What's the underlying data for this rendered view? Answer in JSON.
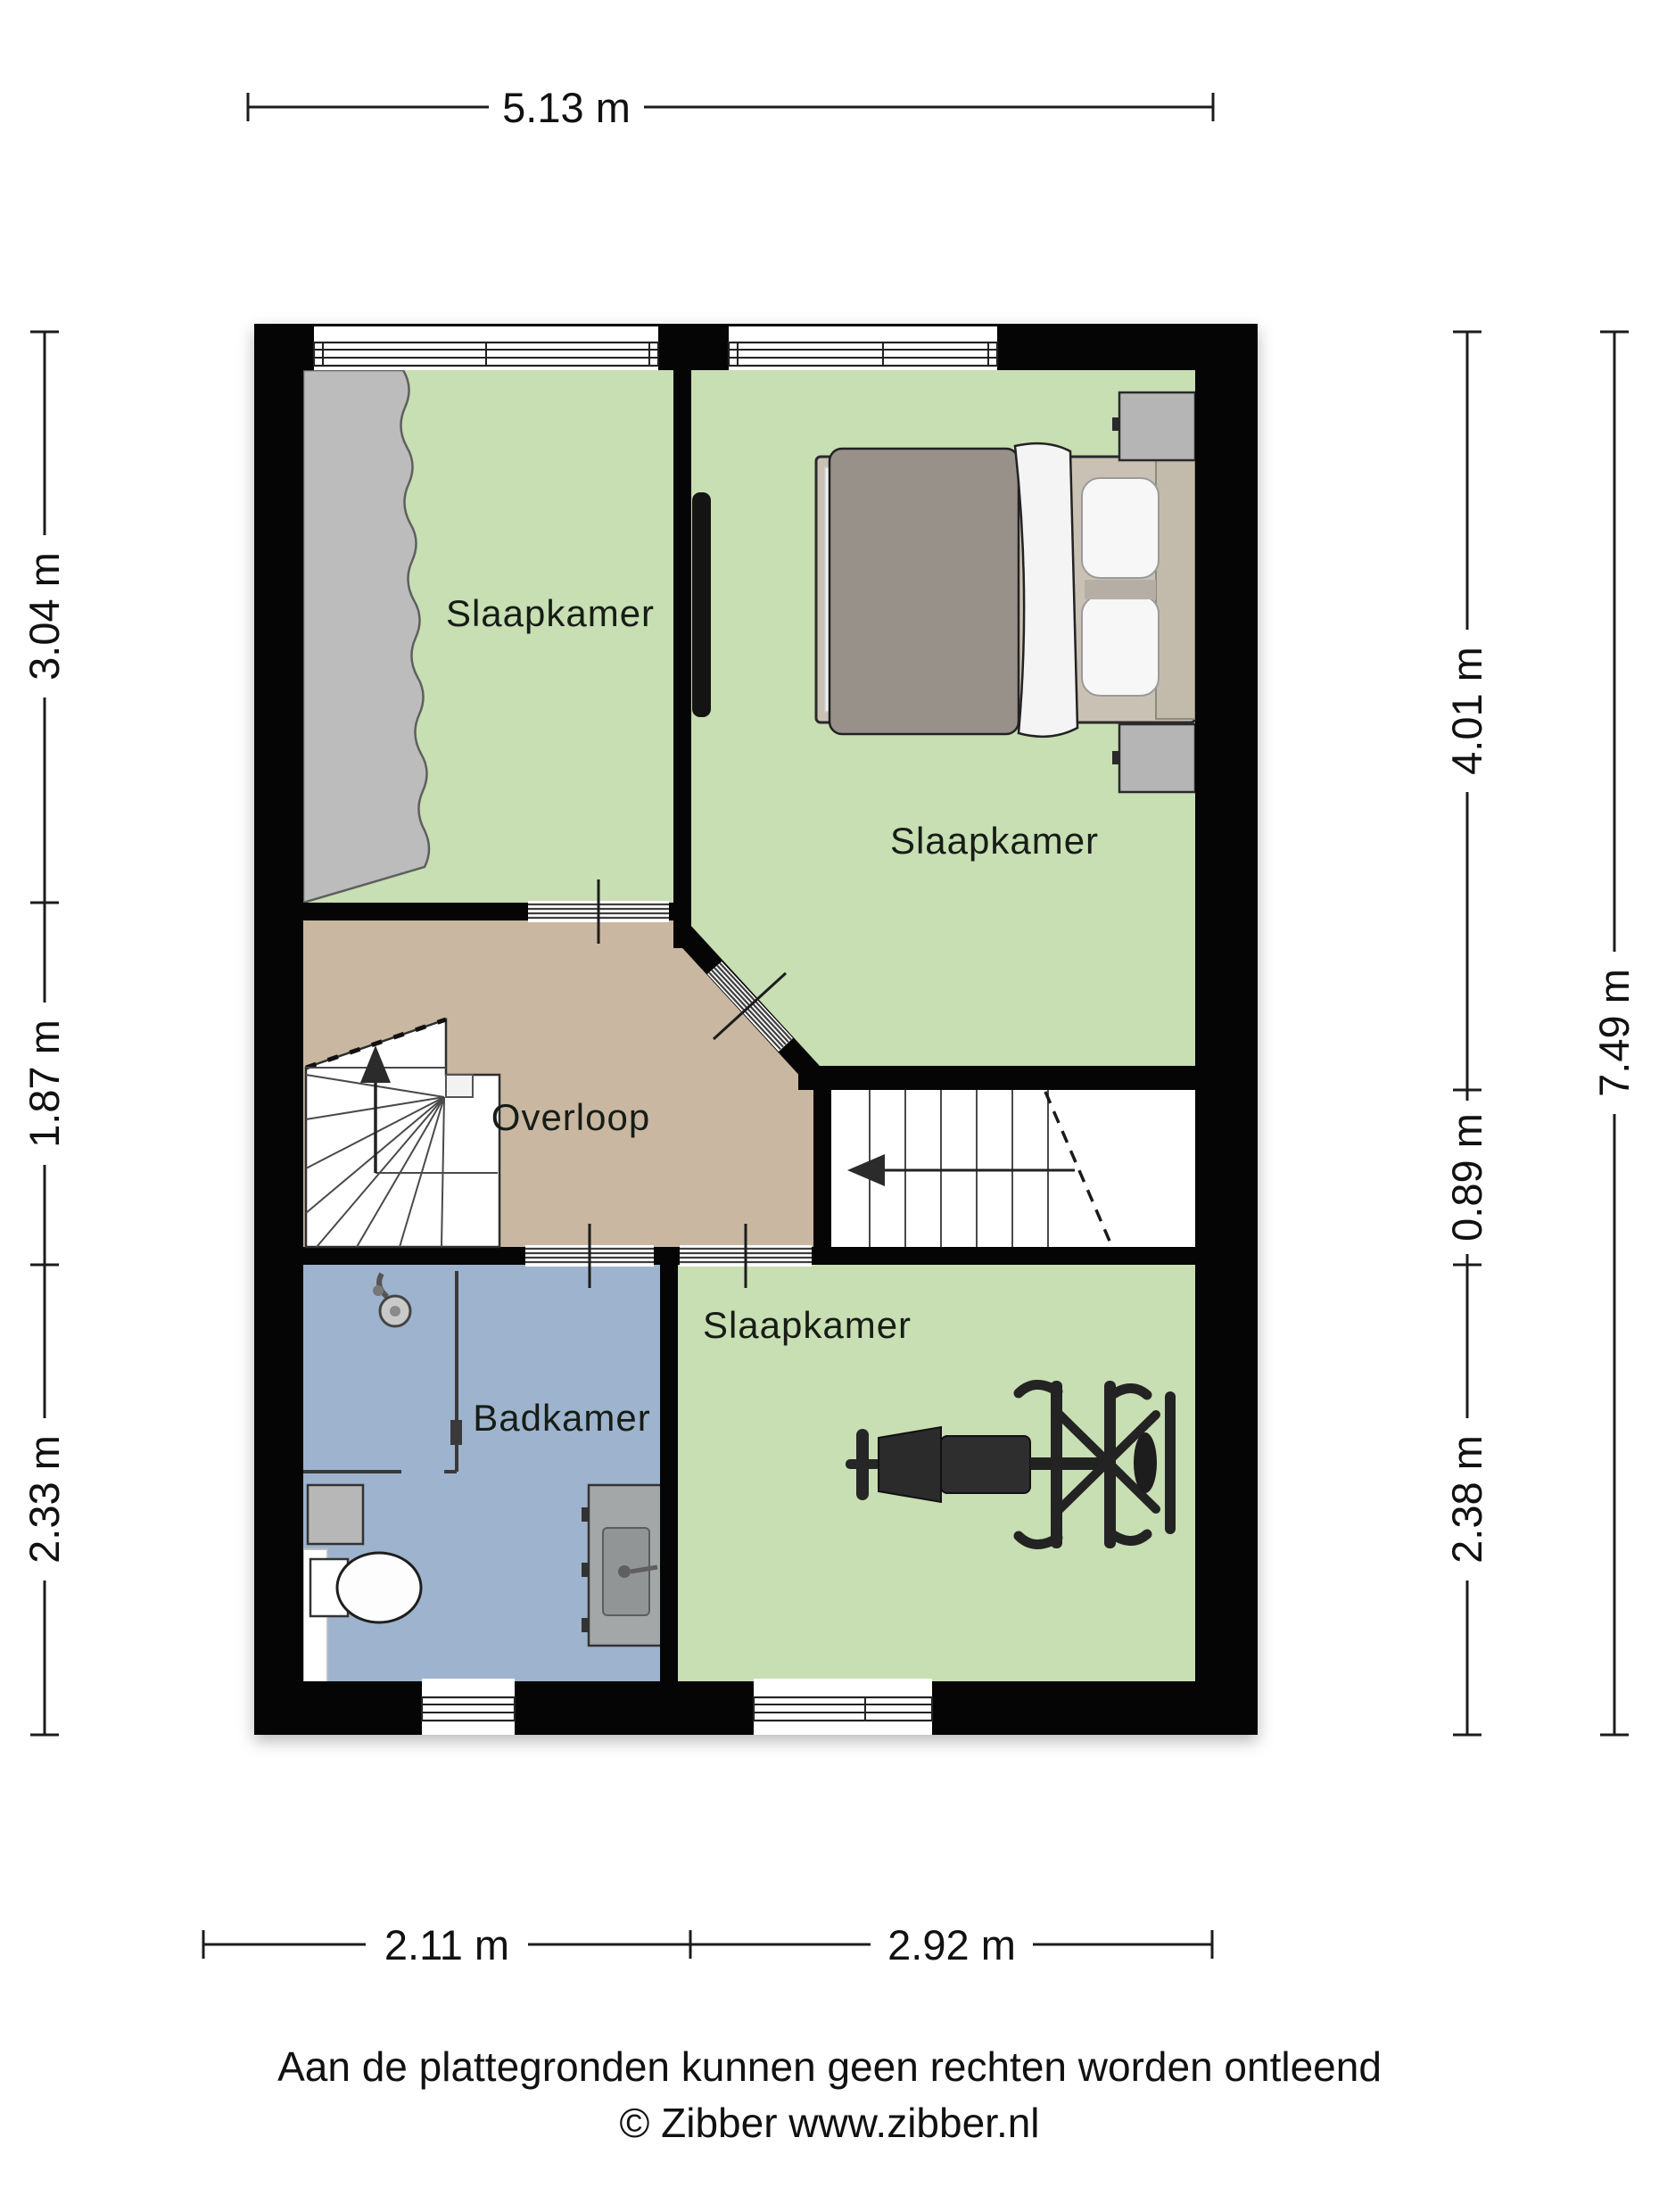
{
  "labels": {
    "bedroom_top_left": "Slaapkamer",
    "bedroom_top_right": "Slaapkamer",
    "bedroom_bottom": "Slaapkamer",
    "landing": "Overloop",
    "bathroom": "Badkamer"
  },
  "dims": {
    "top": "5.13 m",
    "left1": "3.04 m",
    "left2": "1.87 m",
    "left3": "2.33 m",
    "right1": "4.01 m",
    "right2": "0.89 m",
    "right3": "2.38 m",
    "right_total": "7.49 m",
    "bottom1": "2.11 m",
    "bottom2": "2.92 m"
  },
  "footer": {
    "line1": "Aan de plattegronden kunnen geen rechten worden ontleend",
    "line2": "© Zibber www.zibber.nl"
  },
  "colors": {
    "wall": "#050505",
    "floor_bedroom": "#c8deb3",
    "floor_landing": "#c9b7a1",
    "floor_bathroom": "#9eb3cd",
    "wardrobe": "#bcbcbc",
    "furniture_dark": "#262626"
  }
}
